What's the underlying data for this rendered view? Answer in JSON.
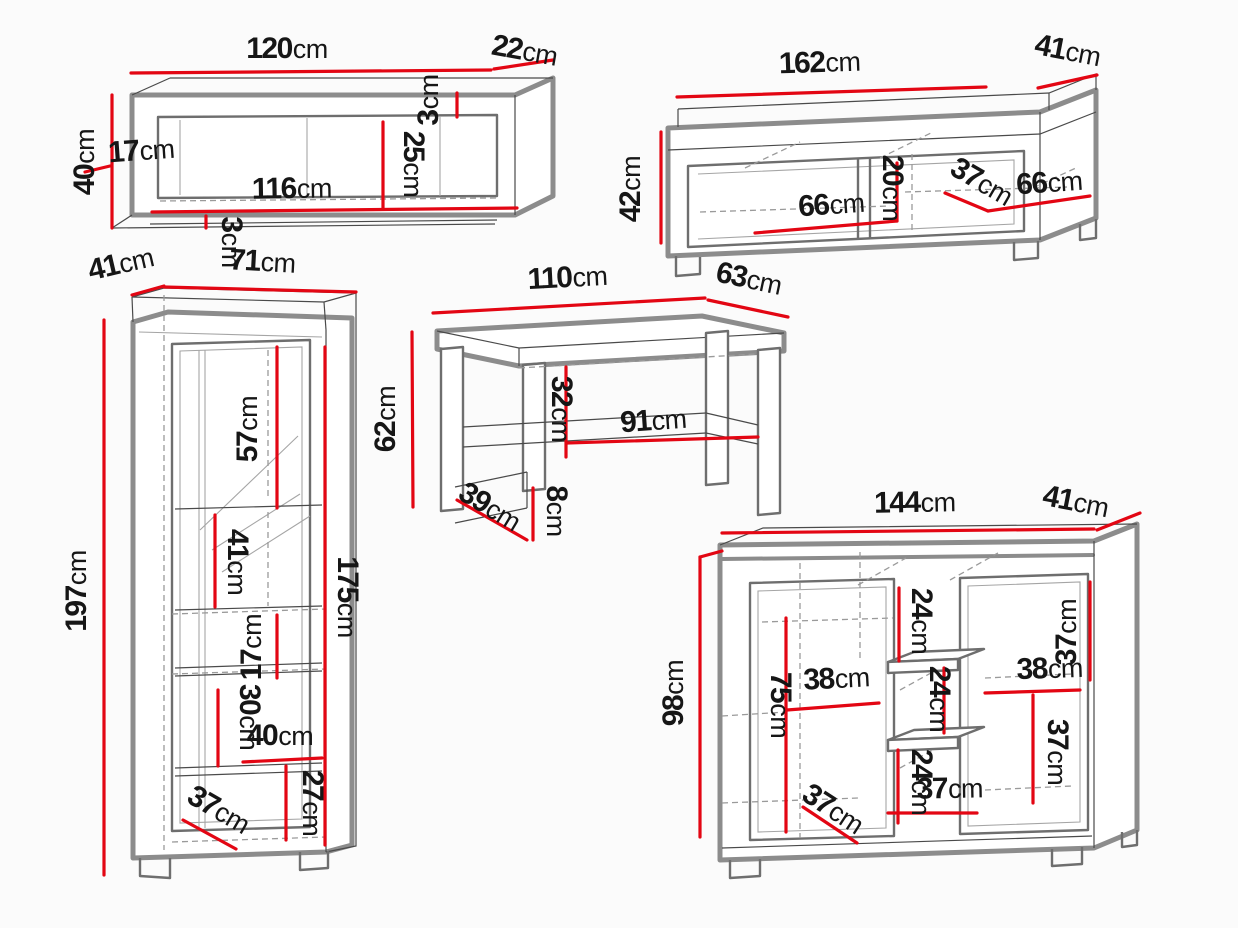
{
  "diagram": {
    "background": "#fbfbfb",
    "dimension_color": "#e30613",
    "outline_color": "#8c8c8c",
    "text_color": "#161616",
    "unit": "cm"
  },
  "pieces": [
    {
      "id": "wall-shelf",
      "dims": [
        {
          "name": "width",
          "value": "120",
          "unit": "cm"
        },
        {
          "name": "depth",
          "value": "22",
          "unit": "cm"
        },
        {
          "name": "height",
          "value": "40",
          "unit": "cm"
        },
        {
          "name": "side-inset",
          "value": "17",
          "unit": "cm"
        },
        {
          "name": "inner-width",
          "value": "116",
          "unit": "cm"
        },
        {
          "name": "inner-height",
          "value": "25",
          "unit": "cm"
        },
        {
          "name": "top-panel",
          "value": "3",
          "unit": "cm"
        },
        {
          "name": "bottom-panel",
          "value": "3",
          "unit": "cm"
        }
      ]
    },
    {
      "id": "tv-stand",
      "dims": [
        {
          "name": "width",
          "value": "162",
          "unit": "cm"
        },
        {
          "name": "depth",
          "value": "41",
          "unit": "cm"
        },
        {
          "name": "height",
          "value": "42",
          "unit": "cm"
        },
        {
          "name": "left-compartment",
          "value": "66",
          "unit": "cm"
        },
        {
          "name": "inner-height",
          "value": "20",
          "unit": "cm"
        },
        {
          "name": "inner-depth",
          "value": "37",
          "unit": "cm"
        },
        {
          "name": "right-compartment",
          "value": "66",
          "unit": "cm"
        }
      ]
    },
    {
      "id": "display-cabinet",
      "dims": [
        {
          "name": "depth",
          "value": "41",
          "unit": "cm"
        },
        {
          "name": "width",
          "value": "71",
          "unit": "cm"
        },
        {
          "name": "height",
          "value": "197",
          "unit": "cm"
        },
        {
          "name": "top-section",
          "value": "57",
          "unit": "cm"
        },
        {
          "name": "mid-section",
          "value": "41",
          "unit": "cm"
        },
        {
          "name": "inner-height",
          "value": "175",
          "unit": "cm"
        },
        {
          "name": "shelf-gap",
          "value": "17",
          "unit": "cm"
        },
        {
          "name": "drawer-section",
          "value": "30",
          "unit": "cm"
        },
        {
          "name": "inner-width",
          "value": "40",
          "unit": "cm"
        },
        {
          "name": "bottom-section",
          "value": "27",
          "unit": "cm"
        },
        {
          "name": "inner-depth",
          "value": "37",
          "unit": "cm"
        }
      ]
    },
    {
      "id": "coffee-table",
      "dims": [
        {
          "name": "width",
          "value": "110",
          "unit": "cm"
        },
        {
          "name": "depth",
          "value": "63",
          "unit": "cm"
        },
        {
          "name": "height",
          "value": "62",
          "unit": "cm"
        },
        {
          "name": "shelf-clearance",
          "value": "32",
          "unit": "cm"
        },
        {
          "name": "shelf-width",
          "value": "91",
          "unit": "cm"
        },
        {
          "name": "leg-spacing",
          "value": "39",
          "unit": "cm"
        },
        {
          "name": "rail-height",
          "value": "8",
          "unit": "cm"
        }
      ]
    },
    {
      "id": "sideboard",
      "dims": [
        {
          "name": "width",
          "value": "144",
          "unit": "cm"
        },
        {
          "name": "depth",
          "value": "41",
          "unit": "cm"
        },
        {
          "name": "height",
          "value": "98",
          "unit": "cm"
        },
        {
          "name": "top-center",
          "value": "24",
          "unit": "cm"
        },
        {
          "name": "top-right",
          "value": "37",
          "unit": "cm"
        },
        {
          "name": "left-shelf",
          "value": "38",
          "unit": "cm"
        },
        {
          "name": "left-height",
          "value": "75",
          "unit": "cm"
        },
        {
          "name": "mid-section",
          "value": "24",
          "unit": "cm"
        },
        {
          "name": "right-shelf",
          "value": "38",
          "unit": "cm"
        },
        {
          "name": "right-section",
          "value": "37",
          "unit": "cm"
        },
        {
          "name": "bottom-center",
          "value": "24",
          "unit": "cm"
        },
        {
          "name": "bottom-width",
          "value": "37",
          "unit": "cm"
        },
        {
          "name": "bottom-depth",
          "value": "37",
          "unit": "cm"
        }
      ]
    }
  ]
}
